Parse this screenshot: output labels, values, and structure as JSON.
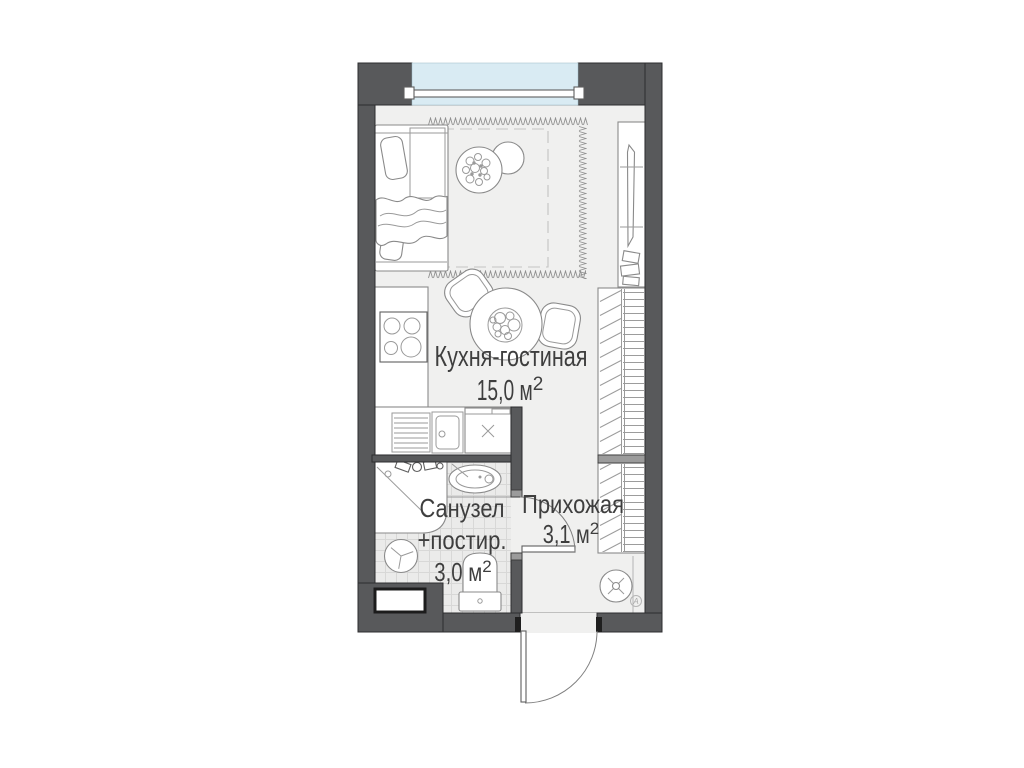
{
  "rooms": {
    "kitchen_living": {
      "name": "Кухня-гостиная",
      "area": "15,0 м",
      "area_sup": "2"
    },
    "bathroom": {
      "name": "Санузел",
      "name2": "+постир.",
      "area": "3,0 м",
      "area_sup": "2"
    },
    "hallway": {
      "name": "Прихожая",
      "area": "3,1 м",
      "area_sup": "2"
    }
  },
  "markers": {
    "circled_letter": "А"
  },
  "colors": {
    "c-wall": "#58595b",
    "c-floor": "#f0f0ef",
    "c-glass": "#d9ebf3",
    "c-tile": "#ebebea",
    "c-text": "#3e3e3e"
  }
}
